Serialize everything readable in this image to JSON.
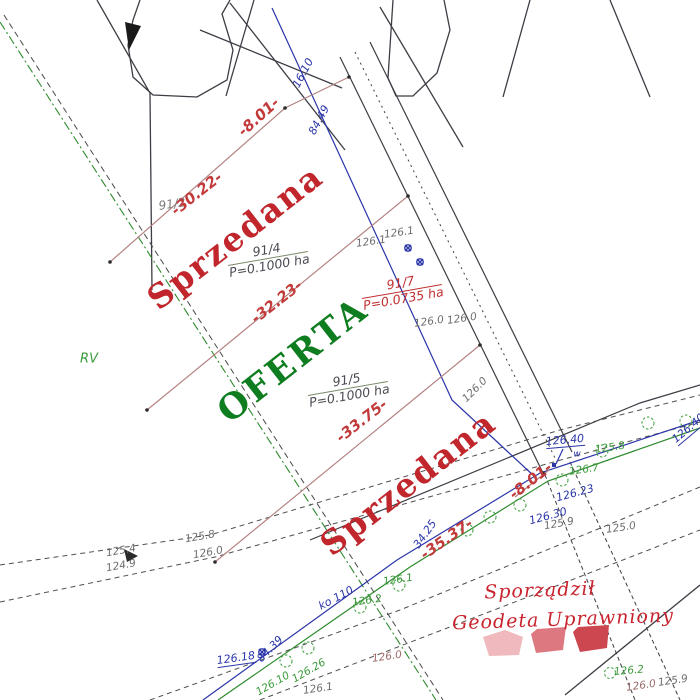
{
  "parcels": {
    "p91_2_id": "91/2",
    "p91_4_id": "91/4",
    "p91_4_area": "P=0.1000 ha",
    "p91_4_status": "Sprzedana",
    "p91_5_id": "91/5",
    "p91_5_area": "P=0.1000 ha",
    "p91_5_status": "OFERTA",
    "p91_7_id": "91/7",
    "p91_7_area": "P=0.0735 ha",
    "p_south_status": "Sprzedana",
    "land_use_code": "RV"
  },
  "dimensions": [
    "-8.01-",
    "-30.22-",
    "-32.23-",
    "-33.75-",
    "-35.37-",
    "-8.01-"
  ],
  "utility_labels": {
    "blue_top_1": "16.10",
    "blue_top_2": "84.49",
    "water_point_1": "126.40",
    "water_marker": "w",
    "water_point_2": "126.40",
    "blue_dim": "34.25",
    "blue_point_1": "126.30",
    "blue_point_2": "126.23",
    "blue_point_3": "126.18",
    "blue_point_4": "84.39",
    "sewer_line": "ko 110"
  },
  "elevations_green": [
    "126.7",
    "125.8",
    "126.2",
    "126.1",
    "126.2",
    "126.10",
    "126.26"
  ],
  "elevations_grey": [
    "126.1",
    "126.1",
    "126.0",
    "126.0",
    "126.0",
    "125.8",
    "126.0",
    "125.4",
    "124.9",
    "125.9",
    "125.0",
    "126.0",
    "126.1",
    "125.9",
    "126.0"
  ],
  "signature": {
    "line1": "Sporządził",
    "line2": "Geodeta Uprawniony"
  },
  "colors": {
    "sold_red": "#c0262c",
    "offer_green": "#0e7d1f",
    "dimension_red": "#c23a3a",
    "water_blue": "#2a35a8",
    "parcel_line_brown": "#b58383",
    "utility_green": "#2e8b2e",
    "boundary_black": "#3d3d45",
    "stamp_red": "#cc4750"
  }
}
